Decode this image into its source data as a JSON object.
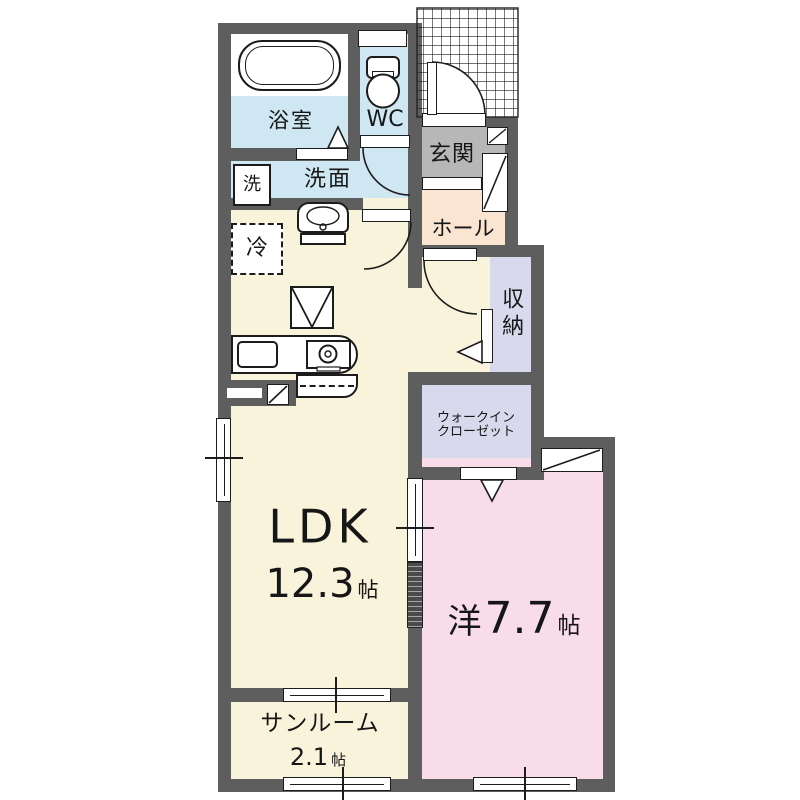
{
  "plan_type": "apartment-floor-plan",
  "colors": {
    "wall": "#5e5e5e",
    "water_blue": "#cfe7f2",
    "floor_cream": "#faf3dc",
    "hall_peach": "#fae4d2",
    "entrance_gray": "#b7b7b7",
    "closet_lavender": "#d9d9ee",
    "bedroom_pink": "#f8dce9",
    "line": "#1c1c1c"
  },
  "rooms": {
    "bathroom": {
      "label": "浴室"
    },
    "toilet": {
      "label": "WC"
    },
    "laundry": {
      "label": "洗"
    },
    "washroom": {
      "label": "洗面"
    },
    "refrigerator": {
      "label": "冷"
    },
    "entrance": {
      "label": "玄関"
    },
    "hall": {
      "label": "ホール"
    },
    "storage": {
      "label": "収納"
    },
    "walk_in_closet": {
      "line1": "ウォークイン",
      "line2": "クローゼット"
    },
    "ldk": {
      "name": "LDK",
      "size": "12.3",
      "unit": "帖"
    },
    "western_room": {
      "prefix": "洋",
      "size": "7.7",
      "unit": "帖"
    },
    "sunroom": {
      "name": "サンルーム",
      "size": "2.1",
      "unit": "帖"
    }
  }
}
